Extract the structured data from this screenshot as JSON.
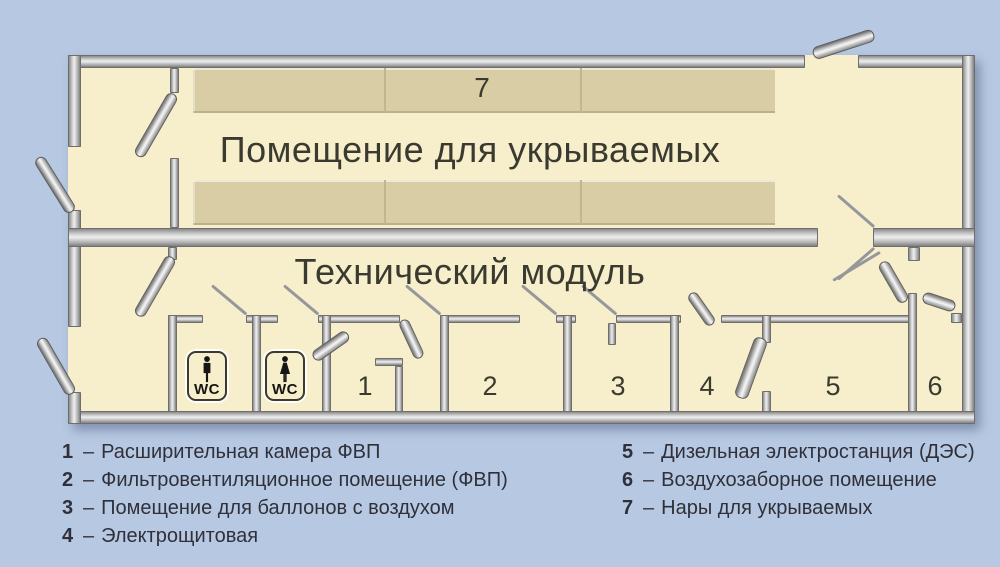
{
  "diagram": {
    "upper_module": {
      "title": "Помещение для укрываемых",
      "bunk_number": "7"
    },
    "technical_module": {
      "title": "Технический модуль",
      "room_numbers": [
        "1",
        "2",
        "3",
        "4",
        "5",
        "6"
      ],
      "wc_rooms": [
        {
          "label": "WC",
          "pictogram": "man-icon"
        },
        {
          "label": "WC",
          "pictogram": "woman-icon"
        }
      ]
    }
  },
  "legend": {
    "separator": "–",
    "left": [
      {
        "number": "1",
        "text": "Расширительная камера ФВП"
      },
      {
        "number": "2",
        "text": "Фильтровентиляционное помещение (ФВП)"
      },
      {
        "number": "3",
        "text": "Помещение для баллонов с воздухом"
      },
      {
        "number": "4",
        "text": "Электрощитовая"
      }
    ],
    "right": [
      {
        "number": "5",
        "text": "Дизельная электростанция (ДЭС)"
      },
      {
        "number": "6",
        "text": "Воздухозаборное помещение"
      },
      {
        "number": "7",
        "text": "Нары для укрываемых"
      }
    ]
  },
  "colors": {
    "background": "#b7c9e2",
    "floor": "#f7efcb",
    "bunk": "#d9cda5",
    "wall_light": "#efefef",
    "wall_dark": "#808080",
    "text": "#33333b"
  }
}
